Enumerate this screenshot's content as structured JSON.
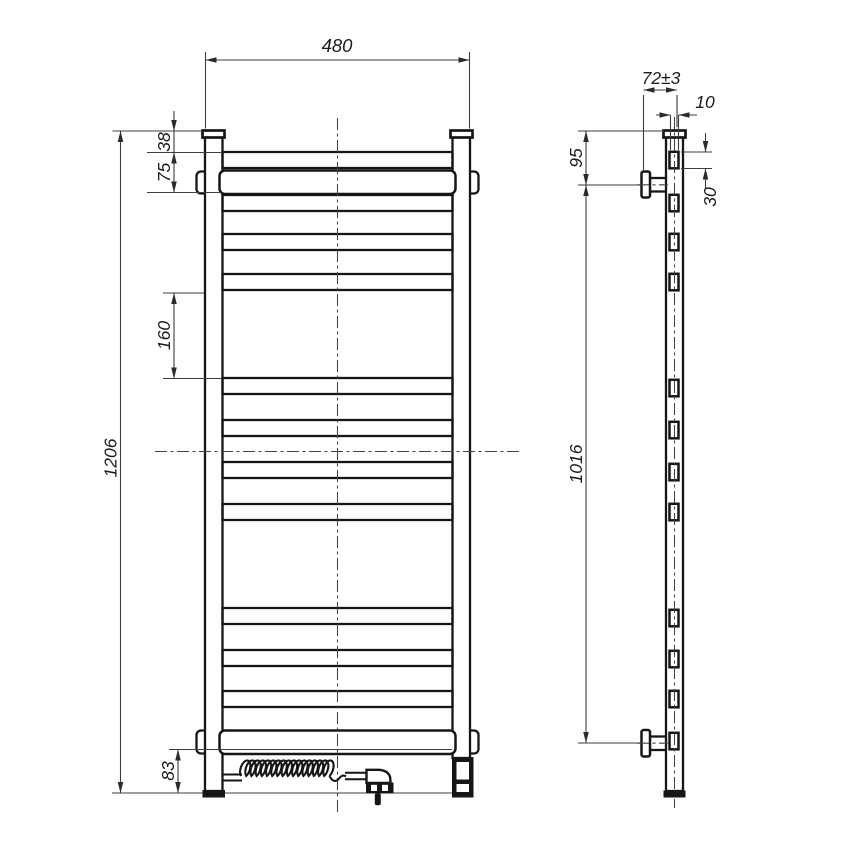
{
  "page": {
    "background": "#ffffff",
    "line_color": "#161616",
    "dimension_color": "#3d3d3d"
  },
  "drawing": {
    "dimensions": {
      "overall_width": "480",
      "top_to_first_rung": "38",
      "rung_pitch": "75",
      "section_gap": "160",
      "overall_height": "1206",
      "bottom_clearance": "83",
      "wall_offset": "72±3",
      "rung_depth": "10",
      "top_to_bracket": "95",
      "bracket_spacing": "1016",
      "rung_face_height": "30"
    }
  }
}
